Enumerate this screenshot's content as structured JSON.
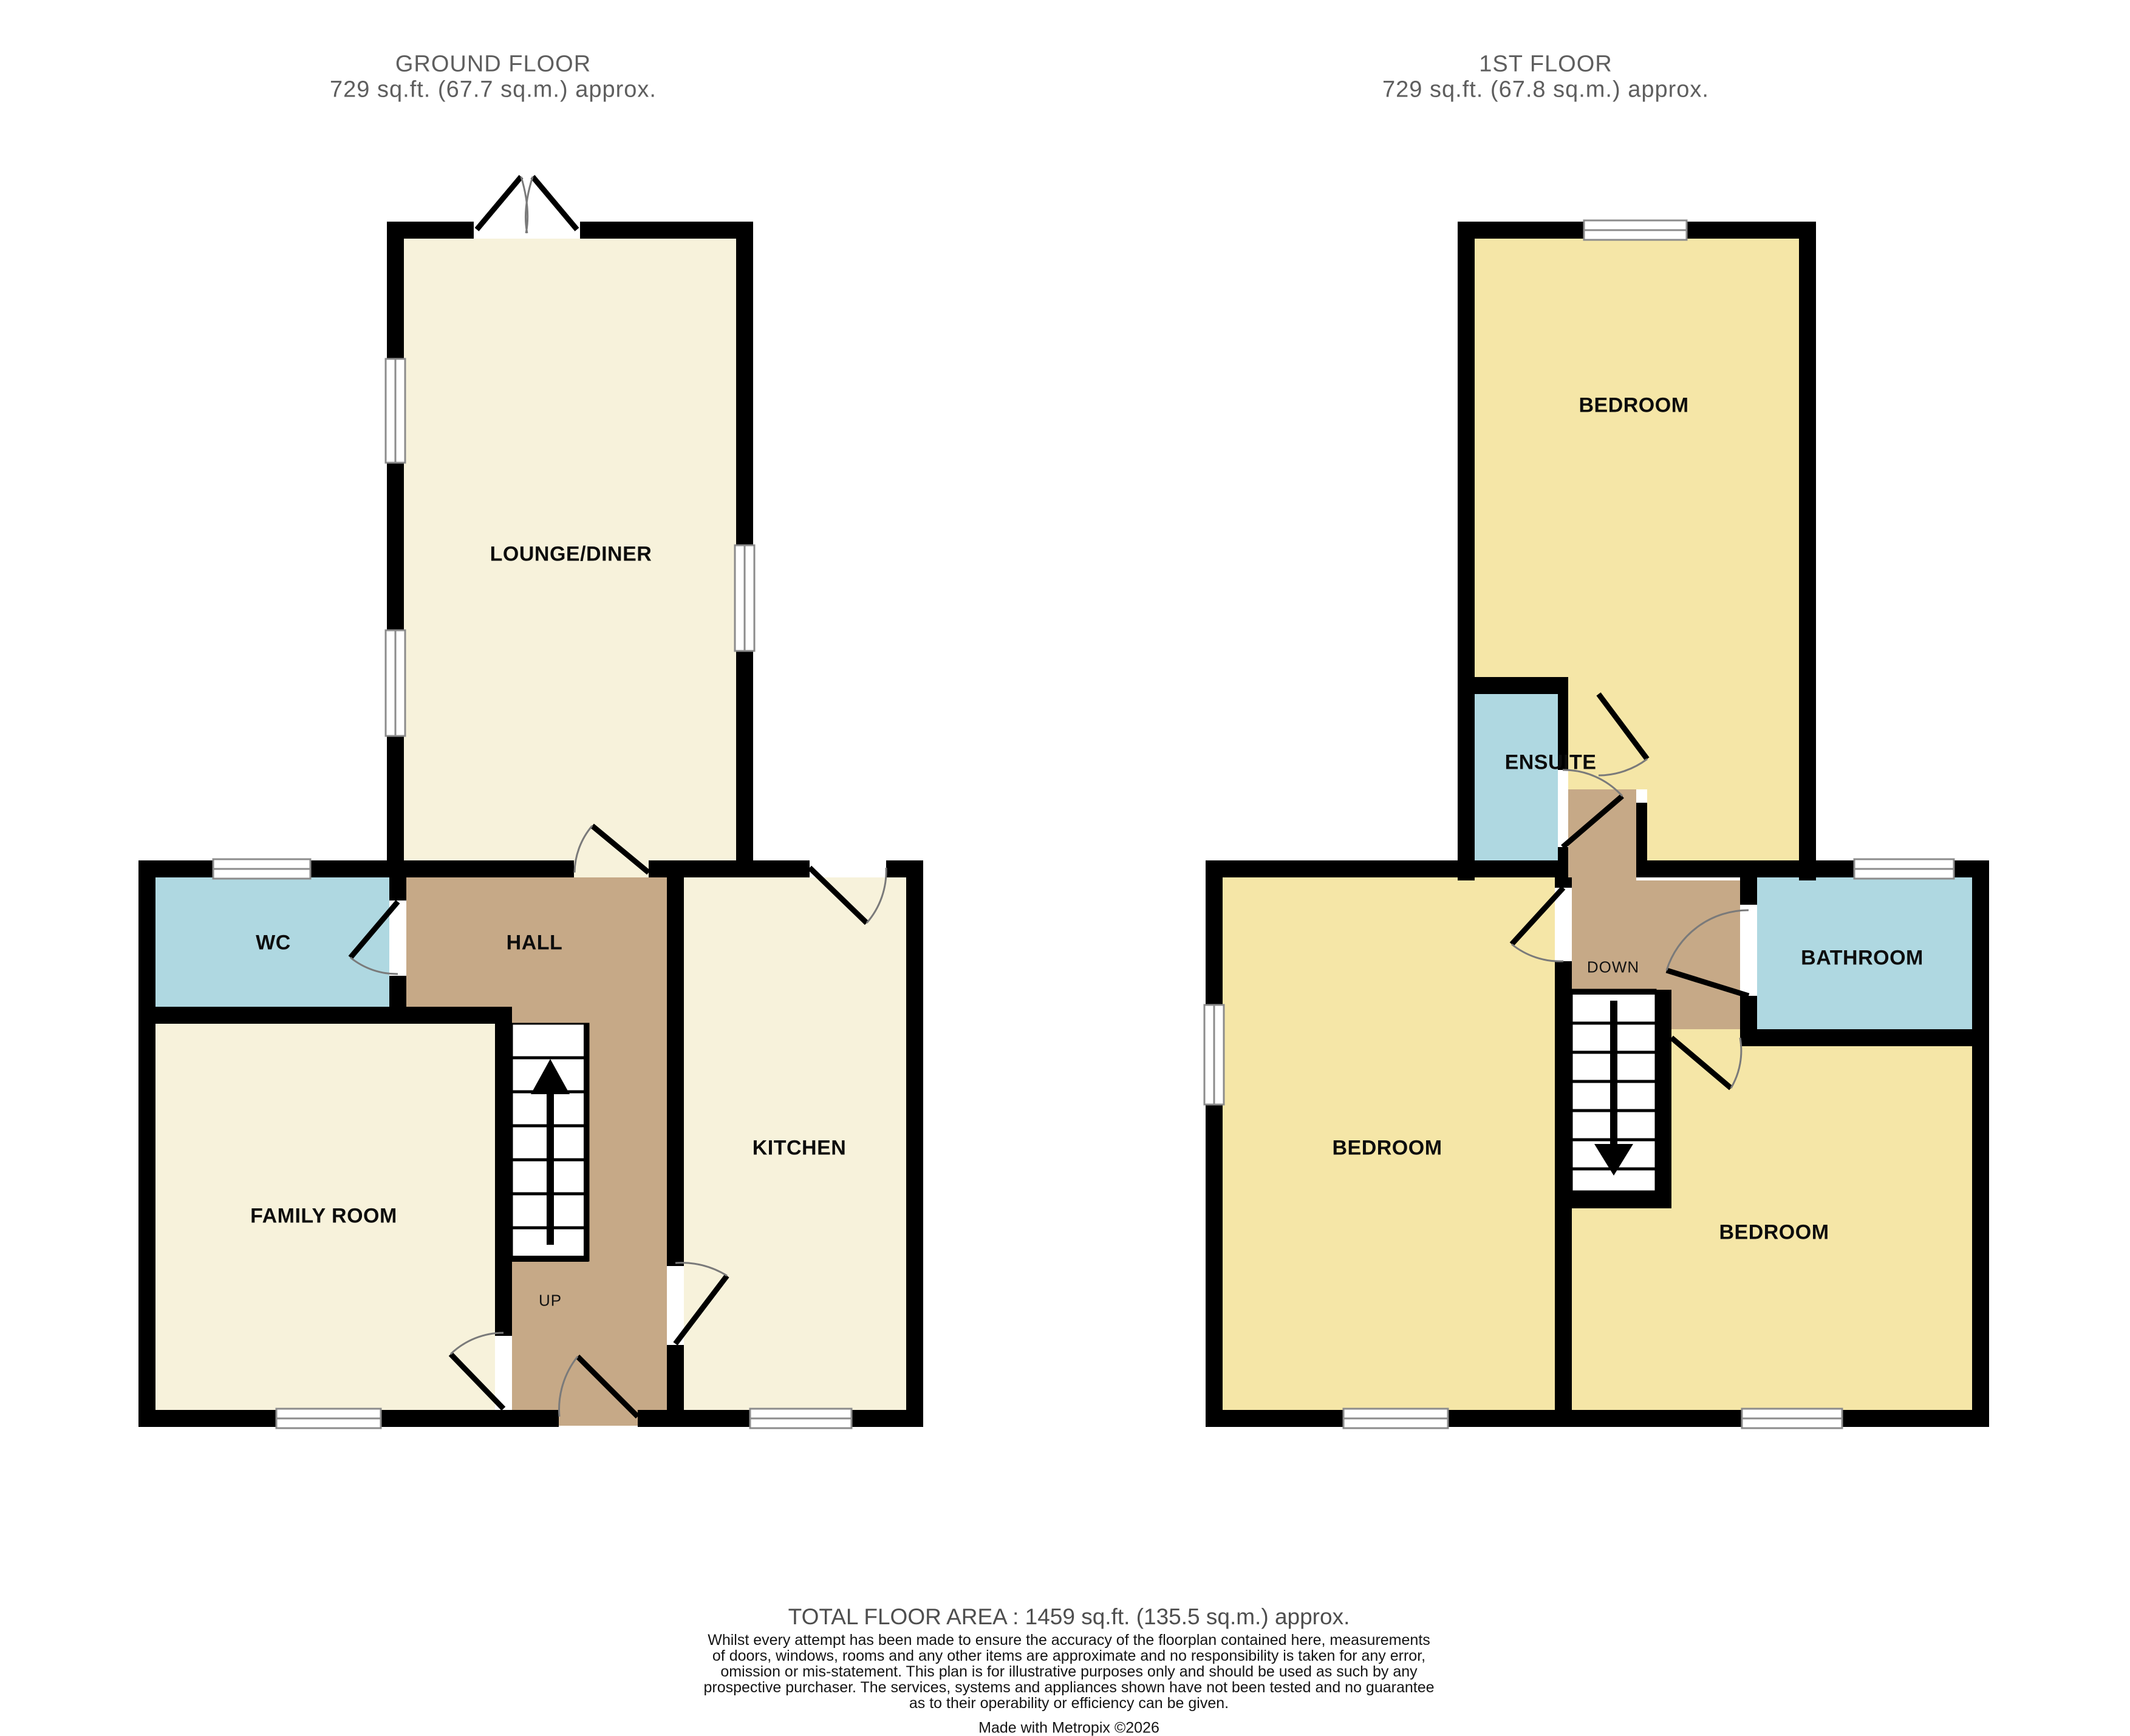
{
  "ground_floor": {
    "title": "GROUND FLOOR",
    "area": "729 sq.ft. (67.7 sq.m.) approx.",
    "rooms": {
      "lounge_diner": "LOUNGE/DINER",
      "wc": "WC",
      "hall": "HALL",
      "family_room": "FAMILY ROOM",
      "kitchen": "KITCHEN"
    },
    "stairs_label": "UP"
  },
  "first_floor": {
    "title": "1ST FLOOR",
    "area": "729 sq.ft. (67.8 sq.m.) approx.",
    "rooms": {
      "bedroom_top": "BEDROOM",
      "ensuite": "ENSUITE",
      "bathroom": "BATHROOM",
      "bedroom_left": "BEDROOM",
      "bedroom_right": "BEDROOM"
    },
    "stairs_label": "DOWN"
  },
  "footer": {
    "total_area": "TOTAL FLOOR AREA : 1459 sq.ft. (135.5 sq.m.) approx.",
    "disclaimer_lines": [
      "Whilst every attempt has been made to ensure the accuracy of the floorplan contained here, measurements",
      "of doors, windows, rooms and any other items are approximate and no responsibility is taken for any error,",
      "omission or mis-statement. This plan is for illustrative purposes only and should be used as such by any",
      "prospective purchaser. The services, systems and appliances shown have not been tested and no guarantee",
      "as to their operability or efficiency can be given."
    ],
    "credit": "Made with Metropix ©2026"
  },
  "colors": {
    "room_cream": "#F7F2DB",
    "room_yellow": "#F5E6A7",
    "room_blue": "#AFD8E1",
    "hall_brown": "#C6A987",
    "wall_black": "#000000",
    "window_line": "#8c8c8c",
    "door_arc": "#7a7a7a"
  }
}
